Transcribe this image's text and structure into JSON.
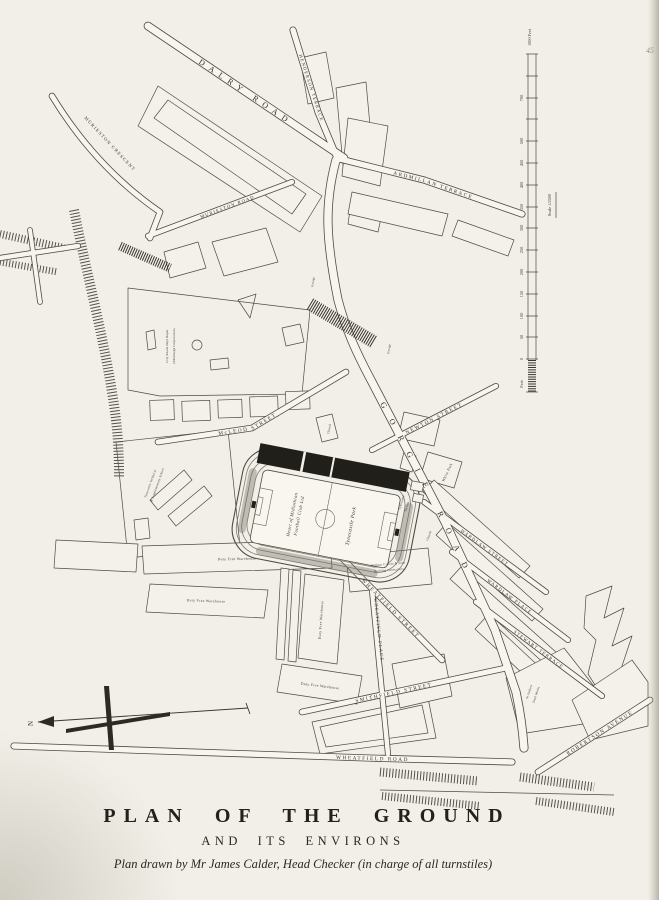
{
  "page": {
    "number": "45"
  },
  "title_block": {
    "title": "PLAN OF THE GROUND",
    "subtitle": "AND ITS ENVIRONS",
    "credit": "Plan drawn by Mr James Calder, Head Checker (in charge of all turnstiles)"
  },
  "compass": {
    "north": "N"
  },
  "scale_bar": {
    "top_label": "1000 Feet",
    "tick_labels": [
      "700",
      "500",
      "450",
      "400",
      "350",
      "300",
      "250",
      "200",
      "150",
      "100",
      "50",
      "0"
    ],
    "bottom_label": "Feet",
    "scale_text": "Scale 1/2500"
  },
  "stadium": {
    "club_line1": "Heart of Midlothian",
    "club_line2": "Football Club Ltd",
    "ground": "Tynecastle Park"
  },
  "streets": [
    {
      "id": "dalry-road",
      "label": "DALRY ROAD"
    },
    {
      "id": "murieston-crescent",
      "label": "MURIESTON CRESCENT"
    },
    {
      "id": "murieston-road",
      "label": "MURIESTON ROAD"
    },
    {
      "id": "henderson-terrace",
      "label": "HENDERSON TERRACE"
    },
    {
      "id": "ardmillan-terrace",
      "label": "ARDMILLAN TERRACE"
    },
    {
      "id": "gorgie-road",
      "label": "GORGIE ROAD"
    },
    {
      "id": "mcleod-street",
      "label": "McLEOD STREET"
    },
    {
      "id": "newton-street",
      "label": "NEWTON STREET"
    },
    {
      "id": "wheatfield-street",
      "label": "WHEATFIELD STREET"
    },
    {
      "id": "wheatfield-place",
      "label": "WHEATFIELD PLACE"
    },
    {
      "id": "wheatfield-road",
      "label": "WHEATFIELD ROAD"
    },
    {
      "id": "smithfield-street",
      "label": "SMITHFIELD STREET"
    },
    {
      "id": "wardlaw-street",
      "label": "WARDLAW STREET"
    },
    {
      "id": "wardlaw-place",
      "label": "WARDLAW PLACE"
    },
    {
      "id": "stewart-terrace",
      "label": "STEWART TERRACE"
    },
    {
      "id": "robertson-avenue",
      "label": "ROBERTSON AVENUE"
    }
  ],
  "places": {
    "white_park": "White Park",
    "school1": "Tynecastle Technical",
    "school2": "& Supplementary School",
    "depot1": "City Roads Dept Depot",
    "depot2": "(Edinburgh Corporation)",
    "warehouse": "Duty Free Warehouse",
    "contractor1": "William Carfrae & Sons",
    "contractor2": "Building Contractors",
    "steelworks1": "St Andrew",
    "steelworks2": "Steel Works",
    "garage": "Garage",
    "church": "Church",
    "tyne_terrace1": "Tynecastle",
    "tyne_terrace2": "Terrace"
  }
}
